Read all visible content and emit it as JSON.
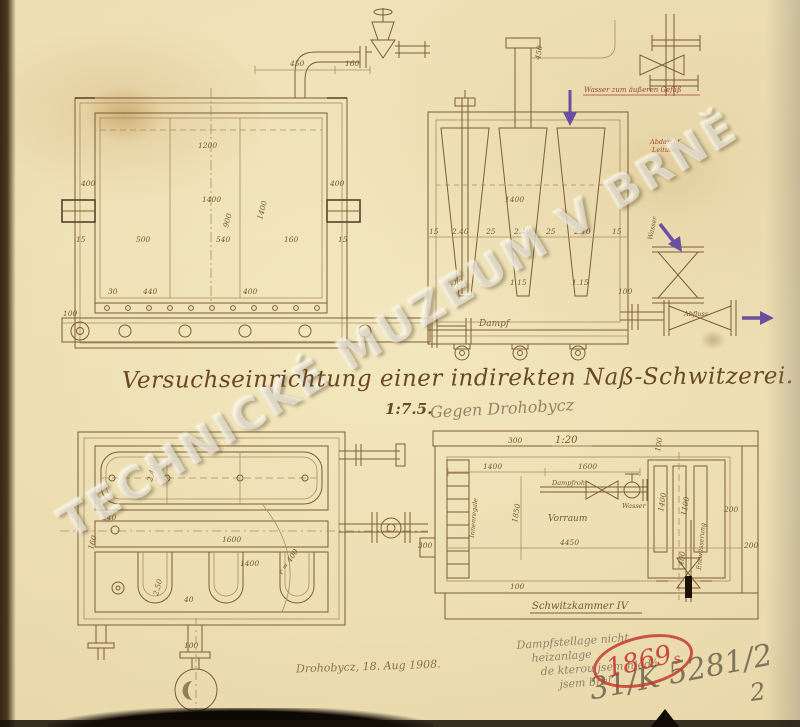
{
  "watermark": "TECHNICKÉ MUZEUM V BRNĚ",
  "title": {
    "text": "Versuchseinrichtung einer indirekten Naß-Schwitzerei.",
    "scale": "1:7.5."
  },
  "annotations": {
    "pencil_above_plan": "Gegen Drohobycz",
    "signature": "Drohobycz, 18. Aug 1908.",
    "notes": [
      "Dampfstellage nicht",
      "heizanlage",
      "de kterou jsem hledá",
      "jsem bral"
    ],
    "file_scrawl": "31/K 5281/2",
    "page_number": "2"
  },
  "stamp": {
    "year": "1869",
    "suffix": "s",
    "color": "#c43b2e"
  },
  "colors": {
    "ink": "#7b5c38",
    "ink_dark": "#55412a",
    "red_ink": "#9a4630",
    "violet": "#6b4fa0",
    "pencil": "#8e8371",
    "paper": "#ead9ad",
    "stamp_red": "#c43b2e"
  },
  "drawings": {
    "top_left": {
      "name": "front section of sweating vessel",
      "labels": [
        "450",
        "160",
        "1200",
        "400",
        "400",
        "1400",
        "900",
        "1400",
        "15",
        "500",
        "540",
        "160",
        "15",
        "30",
        "440",
        "400",
        "100",
        "Dampf"
      ]
    },
    "top_right": {
      "name": "side section with hoppers",
      "labels": [
        "Wasser zum äußeren Gefäß",
        "Abdampf",
        "Leitung",
        "1400",
        "15",
        "2.40",
        "25",
        "2.40",
        "25",
        "2.10",
        "15",
        "1.15",
        "1.15",
        "1.15",
        "100",
        "Wasser",
        "Abfluss",
        "450"
      ]
    },
    "bottom_left": {
      "name": "plan view of vessel",
      "labels": [
        "2.40",
        "1600",
        "1400",
        "160",
        "r = 400",
        "40",
        "100",
        "2.50",
        "240"
      ]
    },
    "bottom_right": {
      "name": "room plan 1:20",
      "labels": [
        "1:20",
        "300",
        "1400",
        "1600",
        "100",
        "1400",
        "1100",
        "200",
        "1850",
        "Vorraum",
        "4450",
        "300",
        "400",
        "100",
        "200",
        "Innenregale",
        "Dampfrohr",
        "Wasser",
        "Entwässerung",
        "Schwitzkammer IV"
      ]
    }
  }
}
